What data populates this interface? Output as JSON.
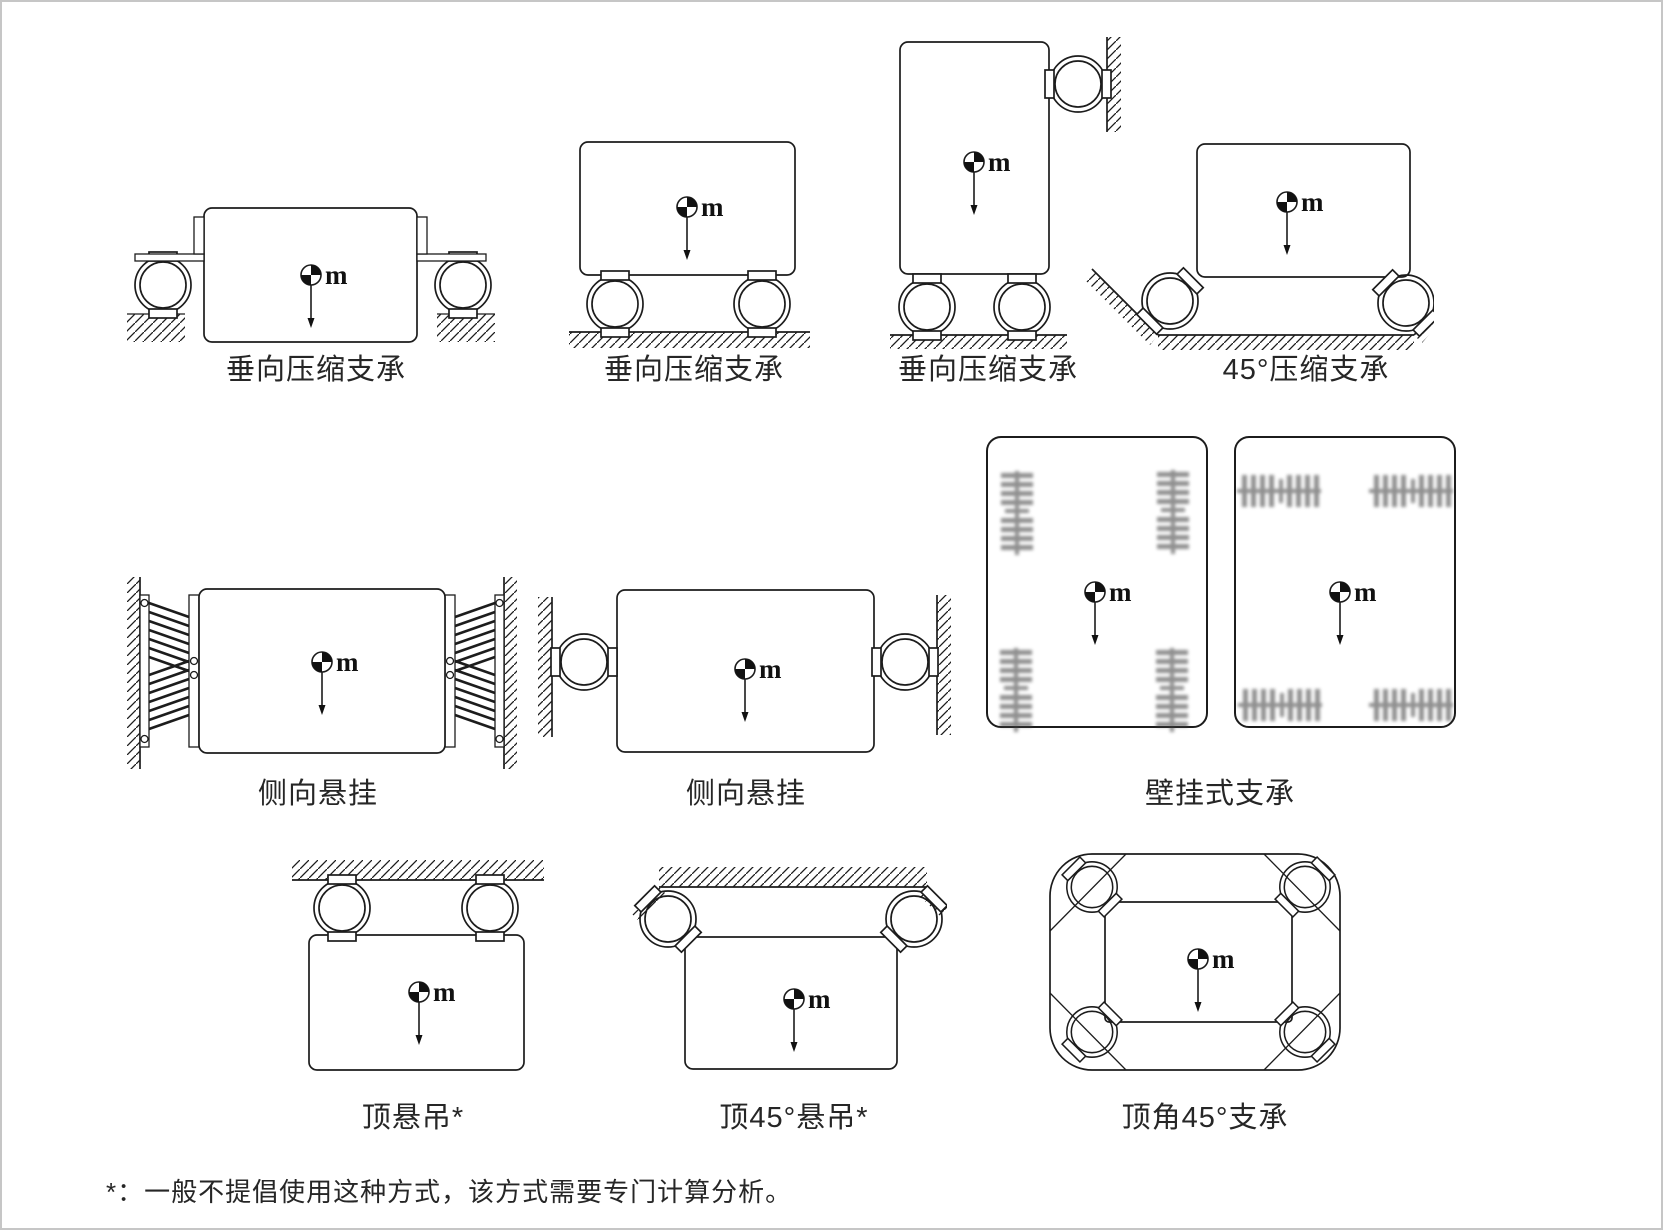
{
  "page": {
    "background": "#ffffff",
    "border_color": "#c6c6c6",
    "ink_color": "#1c1c1c",
    "mass_label": "m",
    "footnote": "*：一般不提倡使用这种方式，该方式需要专门计算分析。"
  },
  "diagrams": [
    {
      "id": "vertical-compression-flange-mount",
      "label": "垂向压缩支承"
    },
    {
      "id": "vertical-compression-base-mount",
      "label": "垂向压缩支承"
    },
    {
      "id": "vertical-compression-wall-steadied",
      "label": "垂向压缩支承"
    },
    {
      "id": "compression-45deg",
      "label": "45°压缩支承"
    },
    {
      "id": "lateral-suspension-coil",
      "label": "侧向悬挂"
    },
    {
      "id": "lateral-suspension-ring",
      "label": "侧向悬挂"
    },
    {
      "id": "wall-mounted-support",
      "label": "壁挂式支承"
    },
    {
      "id": "top-suspension",
      "label": "顶悬吊*"
    },
    {
      "id": "top-45deg-suspension",
      "label": "顶45°悬吊*"
    },
    {
      "id": "top-corner-45deg-support",
      "label": "顶角45°支承"
    }
  ]
}
